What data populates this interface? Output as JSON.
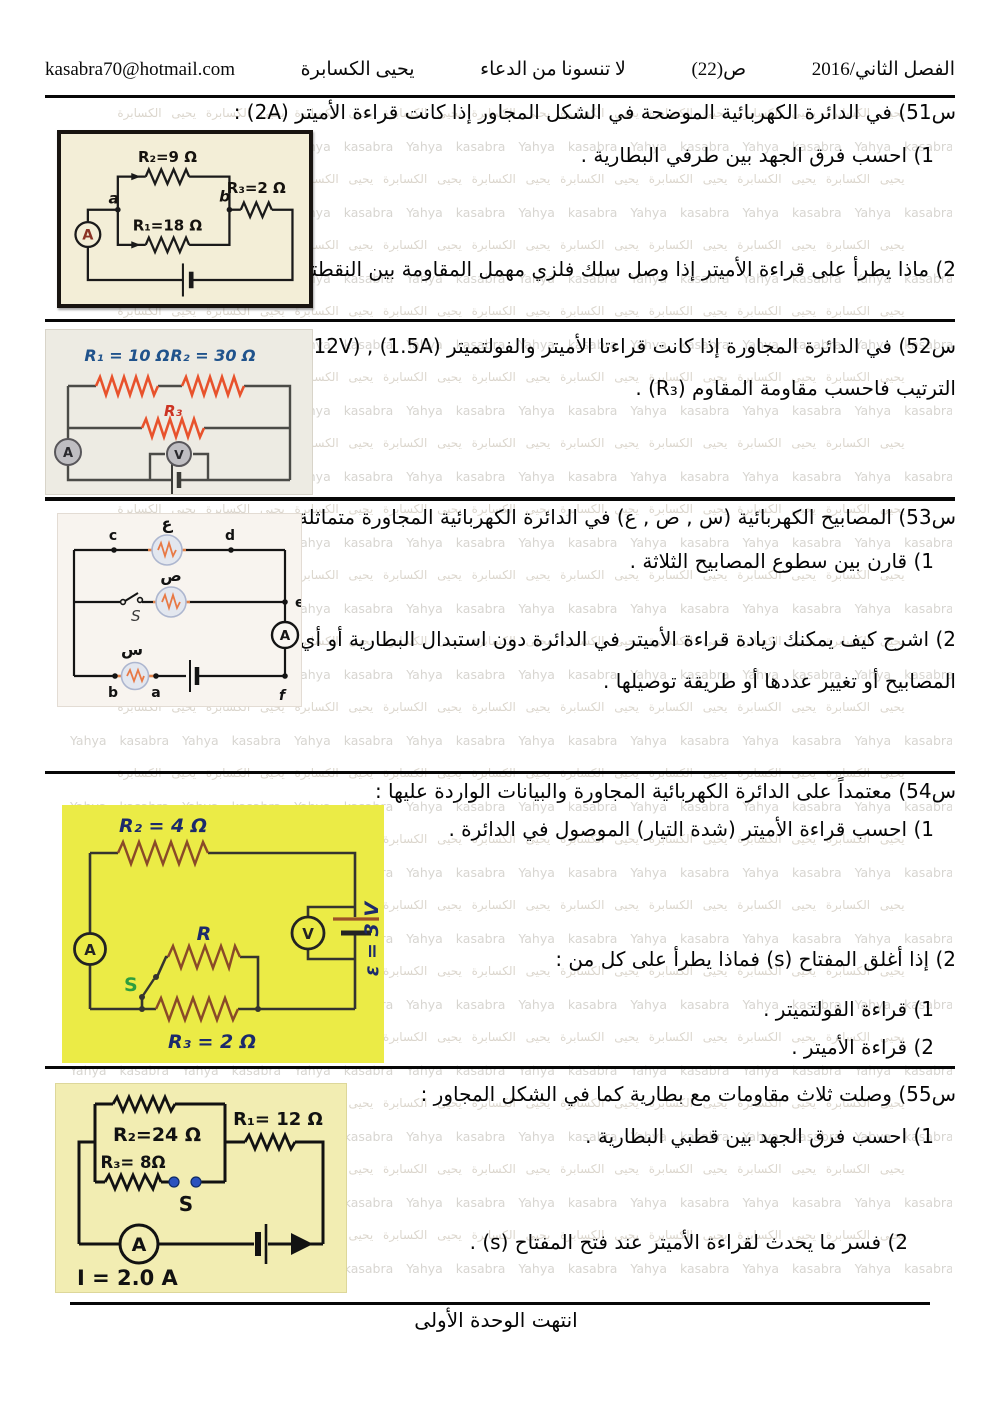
{
  "header": {
    "email": "kasabra70@hotmail.com",
    "author": "يحيى الكسابرة",
    "dua": "لا تنسونا من الدعاء",
    "page_number": "ص(22)",
    "term": "الفصل الثاني/2016"
  },
  "watermark": {
    "arabic": "يحيى الكسابرة يحيى الكسابرة يحيى الكسابرة يحيى الكسابرة يحيى الكسابرة يحيى الكسابرة يحيى الكسابرة يحيى الكسابرة يحيى الكسابرة",
    "latin": "Yahya kasabra  Yahya kasabra  Yahya kasabra  Yahya kasabra  Yahya kasabra  Yahya kasabra  Yahya kasabra  Yahya kasabra"
  },
  "q51": {
    "title": "س51) في الدائرة الكهربائية الموضحة في الشكل المجاور  إذا كانت قراءة الأميتر (2A) :",
    "part1": "1) احسب فرق الجهد بين طرفي البطارية .",
    "part2": "2) ماذا يطرأ على قراءة الأميتر إذا وصل سلك فلزي مهمل المقاومة بين النقطتين (a) و (b) .",
    "circuit": {
      "r2_label": "R₂=9 Ω",
      "r3_label": "R₃=2 Ω",
      "r1_label": "R₁=18 Ω",
      "node_a": "a",
      "node_b": "b",
      "ammeter": "A"
    }
  },
  "q52": {
    "line1": "س52) في الدائرة المجاورة إذا كانت قراءتا الأميتر والفولتميتر (1.5A) , (12V)  على",
    "line2": "الترتيب فاحسب مقاومة المقاوم (R₃) .",
    "circuit": {
      "r1_label": "R₁ = 10 Ω",
      "r2_label": "R₂ = 30 Ω",
      "r3_label": "R₃",
      "ammeter": "A",
      "voltmeter": "V"
    }
  },
  "q53": {
    "title": "س53) المصابيح الكهربائية (س , ص , ع) في الدائرة الكهربائية المجاورة متماثلة :",
    "part1": "1) قارن بين سطوع المصابيح الثلاثة .",
    "part2_line1": "2) اشرح كيف يمكنك زيادة قراءة الأميتر في الدائرة دون استبدال البطارية أو أي من",
    "part2_line2": "المصابيح أو تغيير عددها أو طريقة توصيلها .",
    "circuit": {
      "lamp_top": "ع",
      "lamp_mid": "ص",
      "lamp_bottom": "س",
      "node_c": "c",
      "node_d": "d",
      "node_e": "e",
      "node_f": "f",
      "node_a": "a",
      "node_b": "b",
      "switch": "S",
      "ammeter": "A"
    }
  },
  "q54": {
    "title": "س54) معتمداً على الدائرة الكهربائية المجاورة  والبيانات الواردة عليها :",
    "part1": "1) احسب قراءة الأميتر (شدة التيار) الموصول في الدائرة .",
    "part2": "2) إذا أغلق المفتاح (s) فماذا يطرأ على كل من :",
    "sub1": "1) قراءة الفولتميتر .",
    "sub2": "2) قراءة الأميتر .",
    "circuit": {
      "r2_label": "R₂ = 4 Ω",
      "r_label": "R",
      "r3_label": "R₃ = 2 Ω",
      "switch": "S",
      "ammeter": "A",
      "voltmeter": "V",
      "emf_label": "ε = 3 V"
    }
  },
  "q55": {
    "title": "س55) وصلت ثلاث مقاومات مع بطارية كما في الشكل المجاور :",
    "part1": "1) احسب فرق الجهد بين قطبي البطارية .",
    "part2": "2) فسر  ما يحدث لقراءة الأميتر  عند فتح المفتاح (s) .",
    "circuit": {
      "r2_label": "R₂=24 Ω",
      "r1_label": "R₁= 12 Ω",
      "r3_label": "R₃= 8Ω",
      "switch": "S",
      "ammeter": "A",
      "current_label": "I = 2.0 A"
    }
  },
  "footer": {
    "end_note": "انتهت الوحدة الأولى"
  },
  "colors": {
    "q51_circuit_bg": "#f3eed7",
    "q52_circuit_bg": "#edebe3",
    "q53_circuit_bg": "#f8f4ef",
    "q54_circuit_bg": "#ebeb46",
    "q55_circuit_bg": "#f2edb2",
    "resistor_orange": "#e8522c",
    "resistor_brown": "#8a4a28",
    "label_blue": "#20538c",
    "label_navy": "#1c2a6b",
    "label_red": "#cc3322",
    "switch_green": "#2e9e3e",
    "switch_dot_blue": "#2a52be",
    "ammeter_letter_red": "#8a3324"
  }
}
